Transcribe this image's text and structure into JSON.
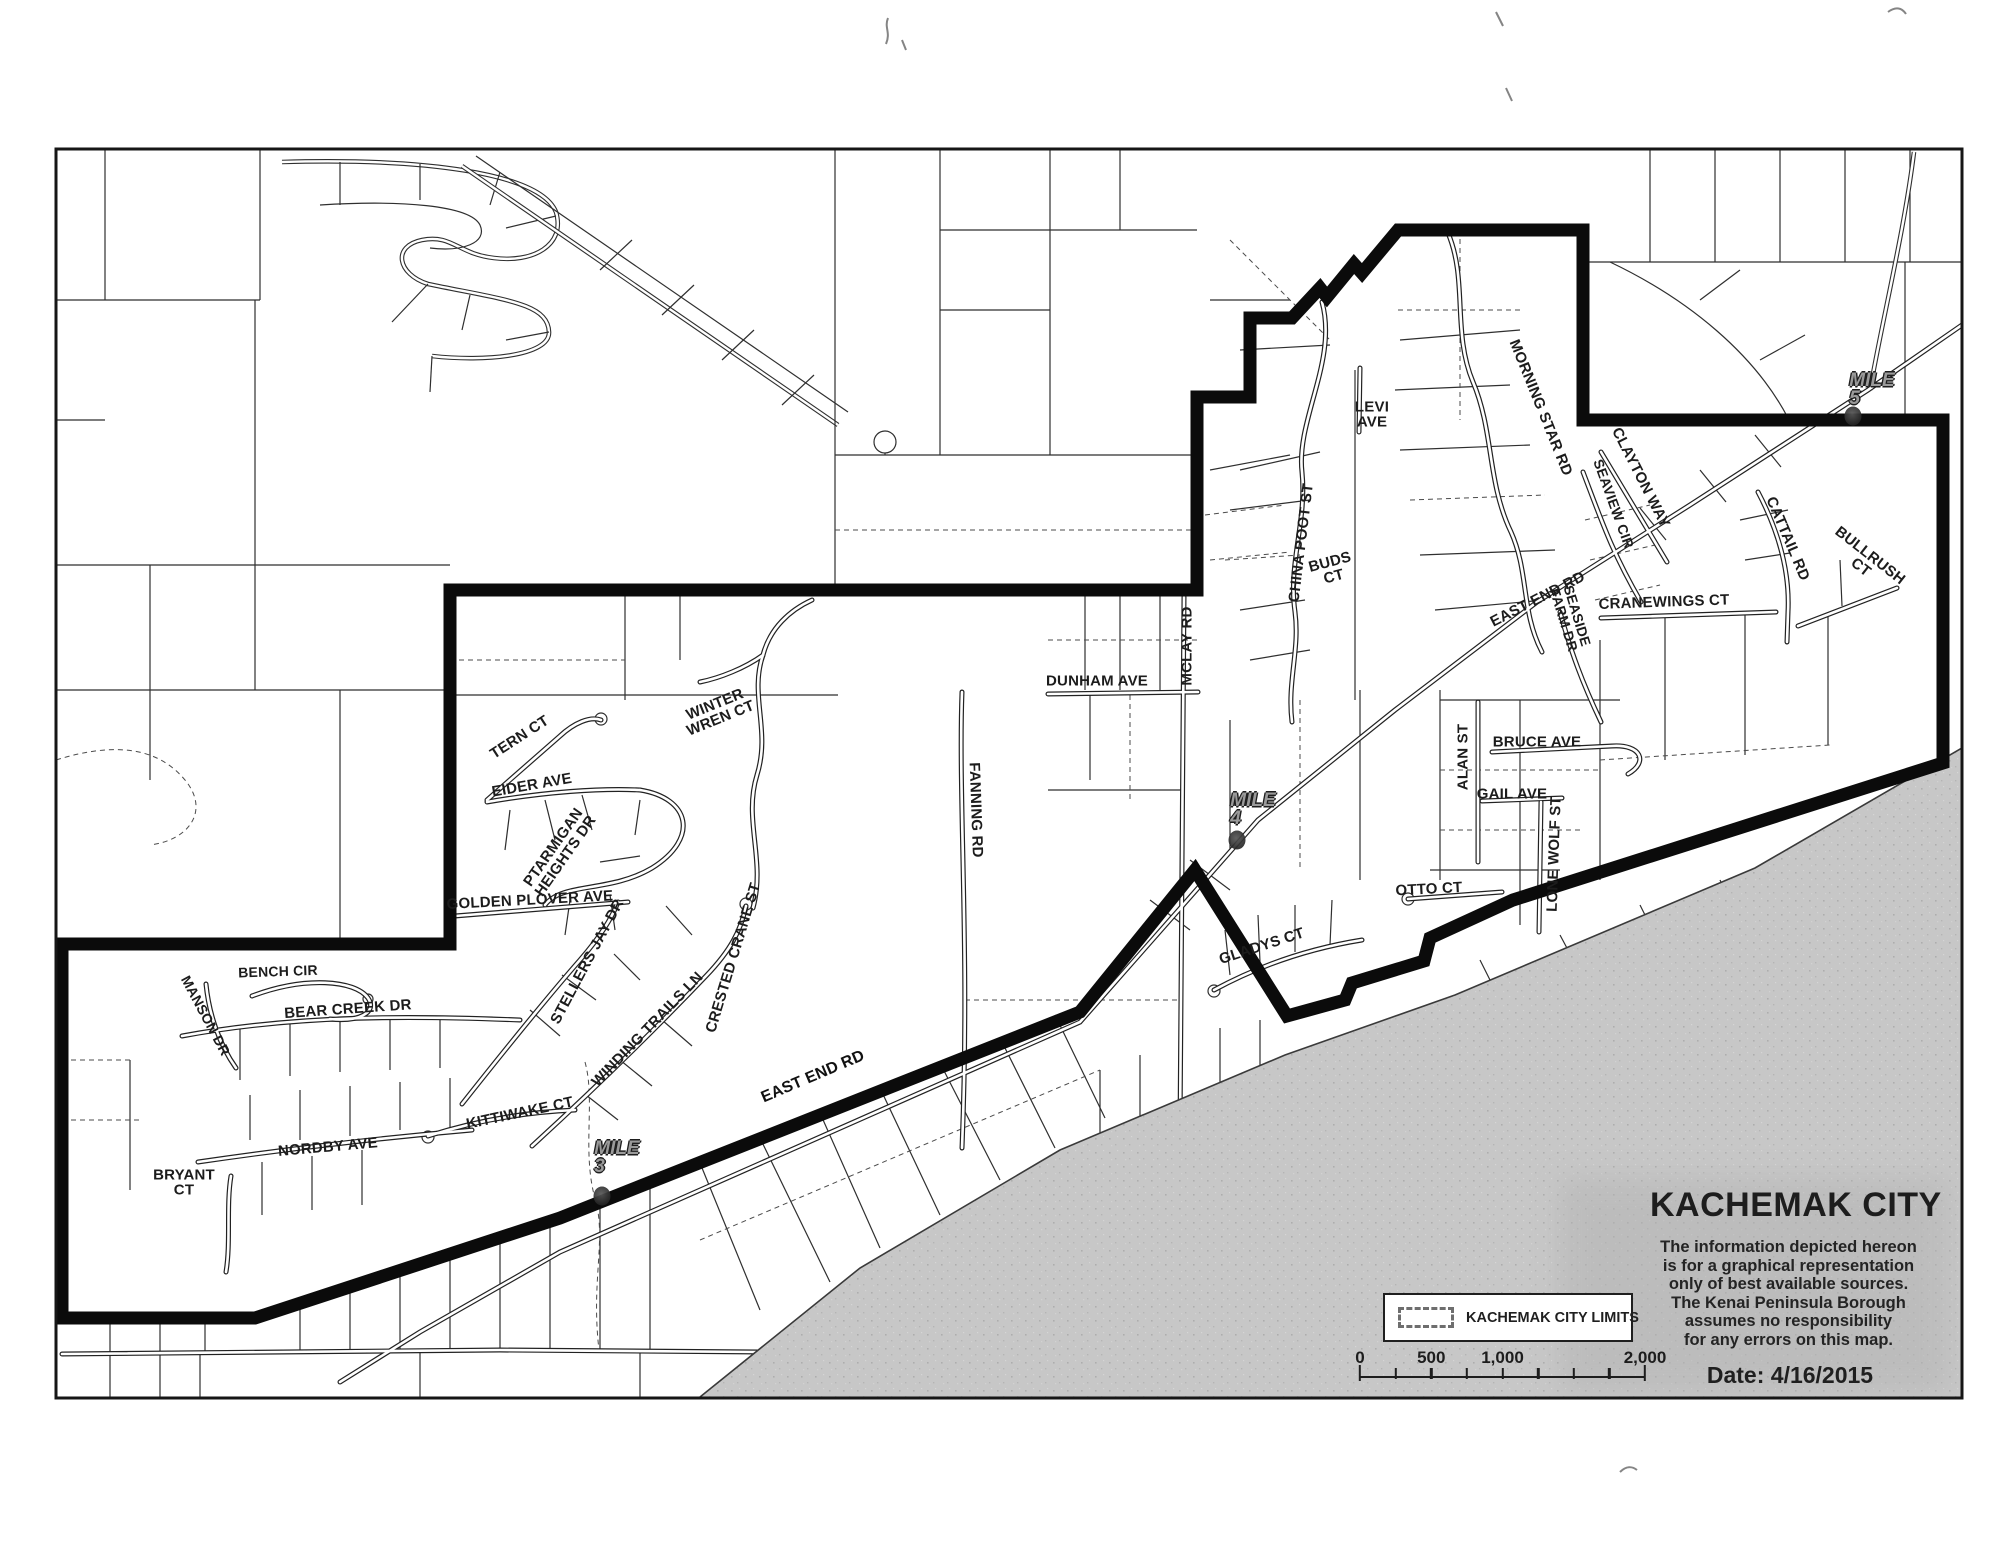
{
  "title_block": {
    "title": "KACHEMAK CITY",
    "disclaimer_lines": [
      "The information depicted hereon",
      "is for a graphical representation",
      "only of best available sources.",
      "The Kenai Peninsula Borough",
      "assumes no responsibility",
      "for any errors on this map."
    ],
    "date_label": "Date: 4/16/2015"
  },
  "legend": {
    "items": [
      {
        "label": "KACHEMAK CITY LIMITS",
        "swatch": "dashed-rectangle"
      }
    ]
  },
  "scale_bar": {
    "tick_labels": [
      {
        "text": "0",
        "frac": 0
      },
      {
        "text": "500",
        "frac": 0.25
      },
      {
        "text": "1,000",
        "frac": 0.5
      },
      {
        "text": "2,000",
        "frac": 1
      }
    ],
    "unit_mark": "'",
    "segments": 8
  },
  "colors": {
    "boundary": "#0b0b0b",
    "water": "#c7c7c7",
    "parcel_line": "#2f2f2f",
    "paper": "#ffffff"
  },
  "map": {
    "city_limits_boundary_points": "62,944 450,944 450,590 1197,590 1197,397 1250,397 1250,318 1292,318 1320,288 1327,297 1354,264 1362,273 1398,230 1583,230 1583,420 1943,420 1943,763 1513,900 1430,938 1424,961 1352,983 1345,1000 1287,1016 1195,870 1080,1012 560,1218 255,1318 62,1318",
    "shoreline_points": "700,1397 860,1268 1060,1150 1285,1055 1455,995 1755,868 1962,748",
    "water_polygon_points": "700,1397 860,1268 1060,1150 1285,1055 1455,995 1755,868 1962,748 1962,1397",
    "street_labels": [
      {
        "id": "tern-ct",
        "lines": [
          "TERN CT"
        ],
        "x": 520,
        "y": 738,
        "rot": -33,
        "fs": 15
      },
      {
        "id": "eider-ave",
        "lines": [
          "EIDER AVE"
        ],
        "x": 532,
        "y": 786,
        "rot": -10,
        "fs": 15
      },
      {
        "id": "ptarmigan-heights-dr",
        "lines": [
          "PTARMIGAN",
          "HEIGHTS DR"
        ],
        "x": 560,
        "y": 852,
        "rot": -55,
        "fs": 15
      },
      {
        "id": "golden-plover-ave",
        "lines": [
          "GOLDEN PLOVER AVE"
        ],
        "x": 530,
        "y": 901,
        "rot": -3,
        "fs": 15
      },
      {
        "id": "stellers-jay-dr",
        "lines": [
          "STELLERS JAY DR"
        ],
        "x": 588,
        "y": 962,
        "rot": -62,
        "fs": 15
      },
      {
        "id": "winter-wren-ct",
        "lines": [
          "WINTER",
          "WREN CT"
        ],
        "x": 718,
        "y": 712,
        "rot": -22,
        "fs": 15
      },
      {
        "id": "crested-crane-st",
        "lines": [
          "CRESTED CRANE ST"
        ],
        "x": 734,
        "y": 958,
        "rot": -73,
        "fs": 15
      },
      {
        "id": "winding-trails-ln",
        "lines": [
          "WINDING TRAILS LN"
        ],
        "x": 648,
        "y": 1030,
        "rot": -46,
        "fs": 15
      },
      {
        "id": "bench-cir",
        "lines": [
          "BENCH CIR"
        ],
        "x": 278,
        "y": 972,
        "rot": -2,
        "fs": 14
      },
      {
        "id": "manson-dr",
        "lines": [
          "MANSON DR"
        ],
        "x": 205,
        "y": 1016,
        "rot": 62,
        "fs": 14
      },
      {
        "id": "bear-creek-dr",
        "lines": [
          "BEAR CREEK DR"
        ],
        "x": 348,
        "y": 1010,
        "rot": -4,
        "fs": 15
      },
      {
        "id": "nordby-ave",
        "lines": [
          "NORDBY AVE"
        ],
        "x": 328,
        "y": 1148,
        "rot": -5,
        "fs": 15
      },
      {
        "id": "bryant-ct",
        "lines": [
          "BRYANT",
          "CT"
        ],
        "x": 184,
        "y": 1183,
        "rot": 0,
        "fs": 15
      },
      {
        "id": "kittiwake-ct",
        "lines": [
          "KITTIWAKE CT"
        ],
        "x": 520,
        "y": 1114,
        "rot": -12,
        "fs": 15
      },
      {
        "id": "fanning-rd",
        "lines": [
          "FANNING RD"
        ],
        "x": 975,
        "y": 810,
        "rot": 88,
        "fs": 15
      },
      {
        "id": "dunham-ave",
        "lines": [
          "DUNHAM AVE"
        ],
        "x": 1097,
        "y": 682,
        "rot": 0,
        "fs": 15
      },
      {
        "id": "mclay-rd",
        "lines": [
          "MCLAY RD"
        ],
        "x": 1188,
        "y": 646,
        "rot": -90,
        "fs": 15
      },
      {
        "id": "china-poot-st",
        "lines": [
          "CHINA POOT ST"
        ],
        "x": 1302,
        "y": 543,
        "rot": -83,
        "fs": 15
      },
      {
        "id": "buds-ct",
        "lines": [
          "BUDS",
          "CT"
        ],
        "x": 1332,
        "y": 570,
        "rot": -15,
        "fs": 15
      },
      {
        "id": "levi-ave",
        "lines": [
          "LEVI",
          "AVE"
        ],
        "x": 1372,
        "y": 415,
        "rot": 0,
        "fs": 15
      },
      {
        "id": "morning-star-rd",
        "lines": [
          "MORNING STAR RD"
        ],
        "x": 1540,
        "y": 408,
        "rot": 68,
        "fs": 15
      },
      {
        "id": "east-end-rd-upper",
        "lines": [
          "EAST END RD"
        ],
        "x": 1538,
        "y": 600,
        "rot": -27,
        "fs": 15
      },
      {
        "id": "seaside-farm-dr",
        "lines": [
          "SEASIDE",
          "FARM DR"
        ],
        "x": 1570,
        "y": 618,
        "rot": 73,
        "fs": 14
      },
      {
        "id": "cranewings-ct",
        "lines": [
          "CRANEWINGS CT"
        ],
        "x": 1664,
        "y": 603,
        "rot": -2,
        "fs": 15
      },
      {
        "id": "clayton-way",
        "lines": [
          "CLAYTON WAY"
        ],
        "x": 1640,
        "y": 478,
        "rot": 63,
        "fs": 15
      },
      {
        "id": "seaview-cir",
        "lines": [
          "SEAVIEW CIR"
        ],
        "x": 1613,
        "y": 504,
        "rot": 70,
        "fs": 14
      },
      {
        "id": "cattail-rd",
        "lines": [
          "CATTAIL RD"
        ],
        "x": 1787,
        "y": 539,
        "rot": 67,
        "fs": 15
      },
      {
        "id": "bullrush-ct",
        "lines": [
          "BULLRUSH",
          "CT"
        ],
        "x": 1865,
        "y": 562,
        "rot": 38,
        "fs": 15
      },
      {
        "id": "bruce-ave",
        "lines": [
          "BRUCE AVE"
        ],
        "x": 1537,
        "y": 743,
        "rot": 0,
        "fs": 15
      },
      {
        "id": "gail-ave",
        "lines": [
          "GAIL AVE"
        ],
        "x": 1512,
        "y": 795,
        "rot": 0,
        "fs": 15
      },
      {
        "id": "alan-st",
        "lines": [
          "ALAN ST"
        ],
        "x": 1464,
        "y": 757,
        "rot": -90,
        "fs": 15
      },
      {
        "id": "otto-ct",
        "lines": [
          "OTTO CT"
        ],
        "x": 1429,
        "y": 890,
        "rot": -3,
        "fs": 15
      },
      {
        "id": "lone-wolf-st",
        "lines": [
          "LONE WOLF ST"
        ],
        "x": 1555,
        "y": 854,
        "rot": -88,
        "fs": 15
      },
      {
        "id": "gladys-ct",
        "lines": [
          "GLADYS CT"
        ],
        "x": 1262,
        "y": 947,
        "rot": -18,
        "fs": 15
      },
      {
        "id": "east-end-rd-lower",
        "lines": [
          "EAST END RD"
        ],
        "x": 813,
        "y": 1077,
        "rot": -23,
        "fs": 16,
        "halo": true
      }
    ],
    "mile_markers": [
      {
        "id": "mile-3",
        "lines": [
          "MILE",
          "3"
        ],
        "x": 617,
        "y": 1158,
        "dot": {
          "x": 602,
          "y": 1196
        }
      },
      {
        "id": "mile-4",
        "lines": [
          "MILE",
          "4"
        ],
        "x": 1253,
        "y": 810,
        "dot": {
          "x": 1237,
          "y": 840
        }
      },
      {
        "id": "mile-5",
        "lines": [
          "MILE",
          "5"
        ],
        "x": 1872,
        "y": 390,
        "dot": {
          "x": 1853,
          "y": 416
        }
      }
    ]
  }
}
